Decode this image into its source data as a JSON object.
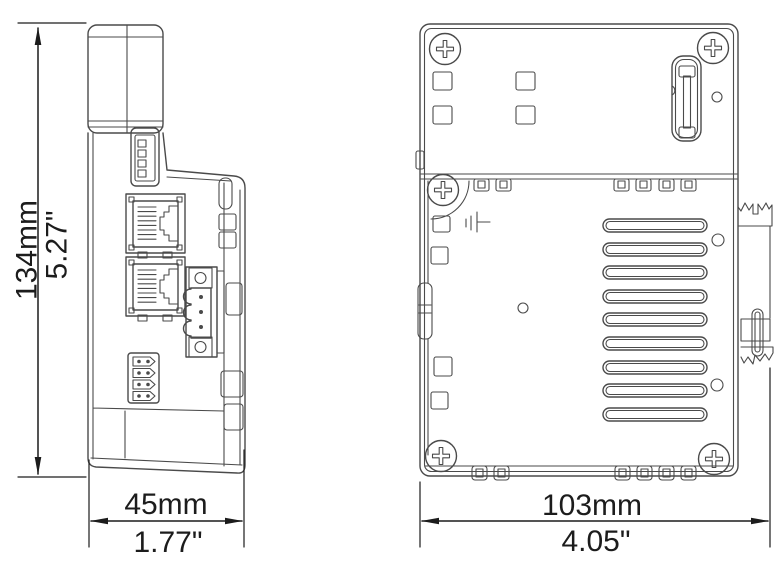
{
  "drawing": {
    "type": "technical-dimension-drawing",
    "background": "#ffffff",
    "line_color": "#4a4a4a",
    "dimension_color": "#1c1c1c",
    "front_view": {
      "height": {
        "metric": "134mm",
        "imperial": "5.27\""
      },
      "width": {
        "metric": "45mm",
        "imperial": "1.77\""
      }
    },
    "side_view": {
      "depth": {
        "metric": "103mm",
        "imperial": "4.05\""
      }
    }
  }
}
